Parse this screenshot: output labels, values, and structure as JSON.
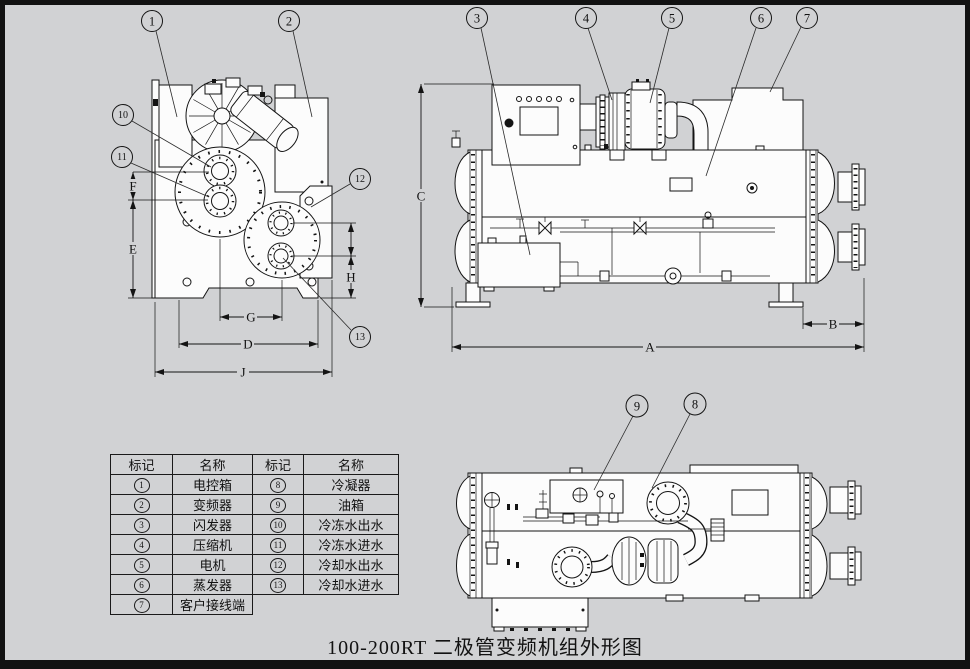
{
  "frame": {
    "background_color": "#d1d2d4",
    "border_color": "#121212"
  },
  "caption": {
    "text": "100-200RT 二极管变频机组外形图"
  },
  "callouts": {
    "c1": "1",
    "c2": "2",
    "c3": "3",
    "c4": "4",
    "c5": "5",
    "c6": "6",
    "c7": "7",
    "c8": "8",
    "c9": "9",
    "c10": "10",
    "c11": "11",
    "c12": "12",
    "c13": "13"
  },
  "dims": {
    "a": "A",
    "b": "B",
    "c": "C",
    "d": "D",
    "e": "E",
    "f": "F",
    "g": "G",
    "h": "H",
    "j": "J"
  },
  "legend_table": {
    "headers": [
      "标记",
      "名称",
      "标记",
      "名称"
    ],
    "rows": [
      [
        "1",
        "电控箱",
        "8",
        "冷凝器"
      ],
      [
        "2",
        "变频器",
        "9",
        "油箱"
      ],
      [
        "3",
        "闪发器",
        "10",
        "冷冻水出水"
      ],
      [
        "4",
        "压缩机",
        "11",
        "冷冻水进水"
      ],
      [
        "5",
        "电机",
        "12",
        "冷却水出水"
      ],
      [
        "6",
        "蒸发器",
        "13",
        "冷却水进水"
      ],
      [
        "7",
        "客户接线端",
        "",
        ""
      ]
    ]
  }
}
